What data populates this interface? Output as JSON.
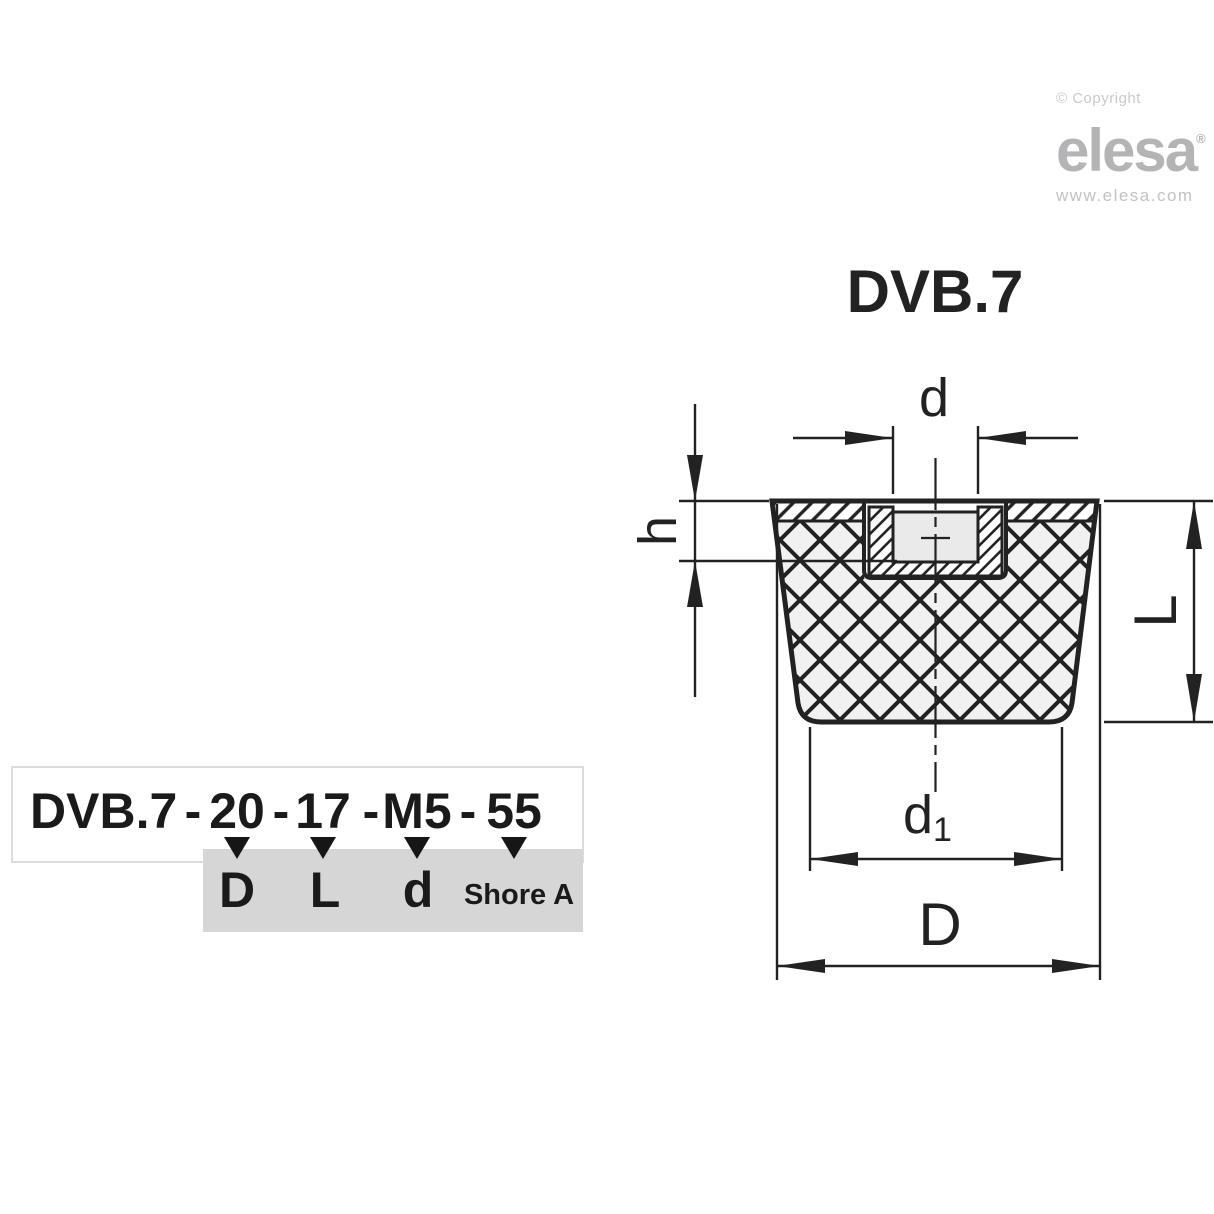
{
  "branding": {
    "copyright": "© Copyright",
    "logo_text": "elesa",
    "registered_mark": "®",
    "website": "www.elesa.com"
  },
  "drawing": {
    "title": "DVB.7",
    "dimension_labels": {
      "thread_diameter": "d",
      "insert_depth": "h",
      "height": "L",
      "bottom_diameter_base": "d",
      "bottom_diameter_sub": "1",
      "top_diameter": "D"
    }
  },
  "ordering_code": {
    "series": "DVB.7",
    "separators": [
      "-",
      "-",
      "-",
      "-"
    ],
    "values": [
      {
        "code": "20",
        "meaning": "D"
      },
      {
        "code": "17",
        "meaning": "L"
      },
      {
        "code": "M5",
        "meaning": "d"
      },
      {
        "code": "55",
        "meaning": "Shore A"
      }
    ]
  },
  "colors": {
    "line": "#222222",
    "rubber_fill": "#f1f1f1",
    "hole_fill": "#eaeaea",
    "gray_panel": "#d6d6d6",
    "box_border": "#dcdcdc",
    "logo_gray": "#b4b4b7",
    "website_gray": "#c2c2c5",
    "copyright_gray": "#c9c9cc",
    "text": "#1a1a1a"
  }
}
